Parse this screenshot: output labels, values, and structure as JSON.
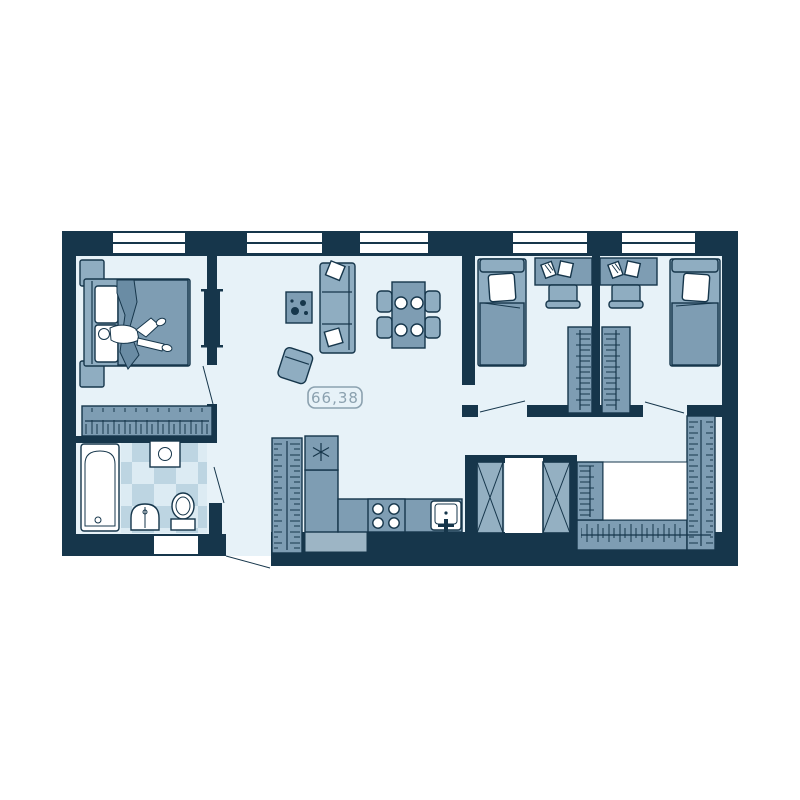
{
  "floor_plan": {
    "area_label": "66,38",
    "window_count": 5,
    "colors": {
      "wall": "#16364b",
      "floor": "#e7f2f8",
      "furn": "#8fadc1",
      "furn2": "#7e9db3",
      "furn3": "#6a8ca4",
      "foot": "#9db5c5",
      "shaft": "#94b0c2",
      "tileA": "#dcebf3",
      "tileB": "#bdd5e2",
      "label": "#8ba1af"
    },
    "fixtures": [
      "double-bed",
      "person-lying",
      "nightstand",
      "wardrobe-hangers",
      "sliding-door",
      "bathtub",
      "washing-machine",
      "wash-basin",
      "toilet",
      "sofa",
      "pillow",
      "coffee-table-with-plant",
      "armchair",
      "dining-table",
      "dining-chair",
      "plate",
      "refrigerator",
      "kitchen-counter",
      "stove-4-burners",
      "kitchen-sink",
      "hall-closet",
      "single-bed",
      "desk-with-books",
      "desk-chair",
      "ventilation-shaft",
      "walk-in-closet",
      "entrance-door",
      "window"
    ]
  }
}
